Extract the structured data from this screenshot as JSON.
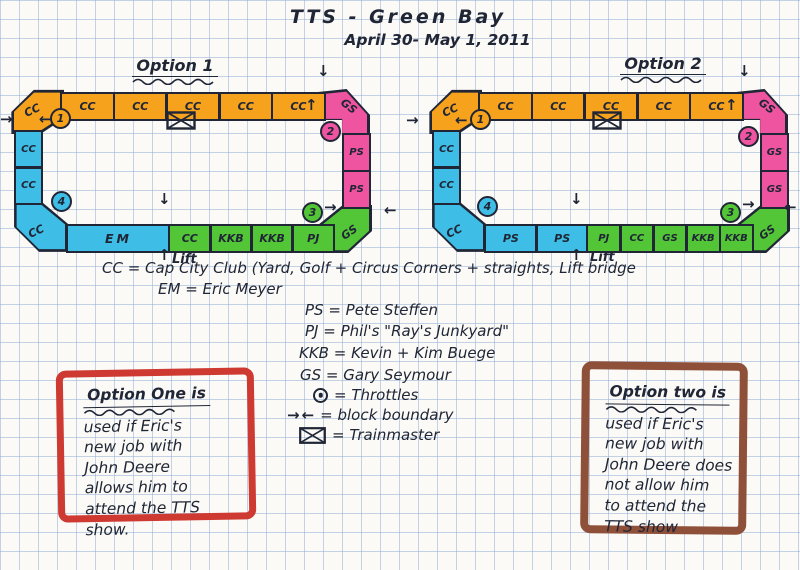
{
  "colors": {
    "ink": "#202636",
    "orange": "#F6A21D",
    "blue": "#3EBEE6",
    "pink": "#EE549F",
    "green": "#53C637",
    "red_frame": "#CE3A32",
    "brown_frame": "#8F5039",
    "paper": "#FBFAF6",
    "grid": "#B7C6E2"
  },
  "title": {
    "line1": "TTS - Green Bay",
    "line2": "April 30- May 1, 2011"
  },
  "icons": {
    "arrow_right": "→",
    "arrow_left": "←",
    "arrow_up": "↑",
    "arrow_down": "↓"
  },
  "option1": {
    "label": "Option 1",
    "corner_tl": "CC",
    "corner_tr": "GS",
    "corner_br": "GS",
    "corner_bl": "CC",
    "top": [
      "CC",
      "CC",
      "CC",
      "CC",
      "CC"
    ],
    "right": [
      "PS",
      "PS"
    ],
    "left": [
      "CC",
      "CC"
    ],
    "bottom_blue": [
      "EM"
    ],
    "bottom_green": [
      "CC",
      "KKB",
      "KKB",
      "PJ"
    ],
    "markers": [
      "1",
      "2",
      "3",
      "4"
    ],
    "lift": "Lift"
  },
  "option2": {
    "label": "Option 2",
    "corner_tl": "CC",
    "corner_tr": "GS",
    "corner_br": "GS",
    "corner_bl": "CC",
    "top": [
      "CC",
      "CC",
      "CC",
      "CC",
      "CC"
    ],
    "right": [
      "GS",
      "GS"
    ],
    "left": [
      "CC",
      "CC"
    ],
    "bottom_blue": [
      "PS",
      "PS"
    ],
    "bottom_green": [
      "PJ",
      "CC",
      "GS",
      "KKB",
      "KKB"
    ],
    "markers": [
      "1",
      "2",
      "3",
      "4"
    ],
    "lift": "Lift"
  },
  "legend": {
    "cc": "CC = Cap City Club (Yard, Golf + Circus Corners + straights, Lift bridge",
    "em": "EM = Eric Meyer",
    "ps": "PS = Pete Steffen",
    "pj": "PJ = Phil's \"Ray's Junkyard\"",
    "kkb": "KKB = Kevin + Kim Buege",
    "gs": "GS = Gary Seymour",
    "throttles": "= Throttles",
    "block_boundary": "= block boundary",
    "trainmaster": "= Trainmaster"
  },
  "notes": {
    "option_one": {
      "heading": "Option One is",
      "lines": [
        "used if Eric's",
        "new job with",
        "John Deere",
        "allows him to",
        "attend the TTS",
        "show."
      ]
    },
    "option_two": {
      "heading": "Option two is",
      "lines": [
        "used if Eric's",
        "new job with",
        "John Deere does",
        "not allow him",
        "to attend the",
        "TTS show"
      ]
    }
  }
}
